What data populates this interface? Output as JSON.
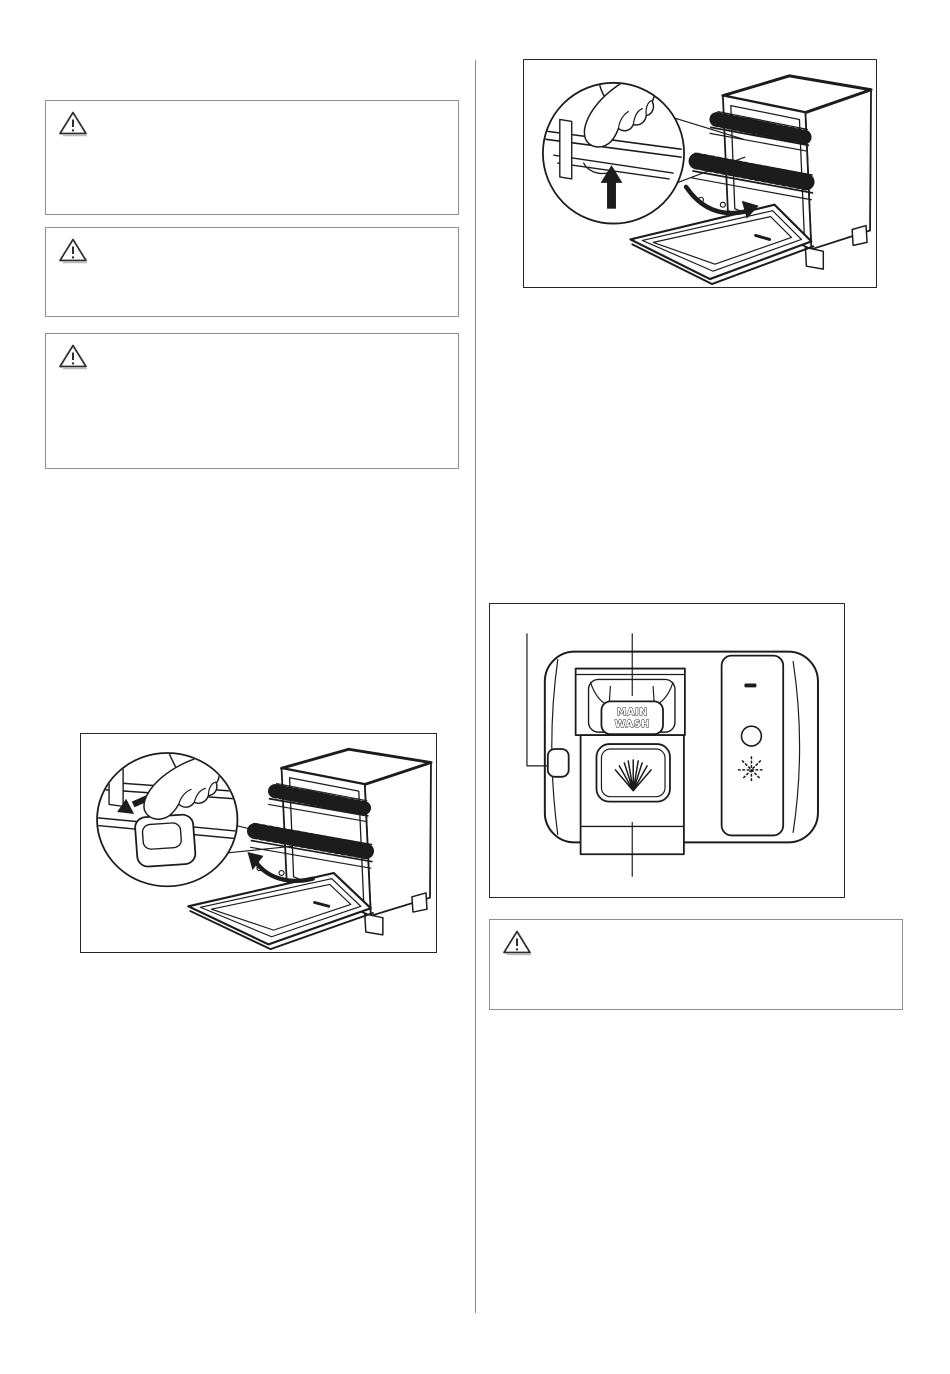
{
  "colors": {
    "page_background": "#ffffff",
    "art_line": "#1c1c1c",
    "warning_box_border": "#8f8f8f",
    "column_divider": "#8a8a8a",
    "arrow_fill": "#1c1c1c"
  },
  "warning_boxes": [
    {
      "name": "warning-box-1",
      "icon": "warning-triangle-icon",
      "text": ""
    },
    {
      "name": "warning-box-2",
      "icon": "warning-triangle-icon",
      "text": ""
    },
    {
      "name": "warning-box-3",
      "icon": "warning-triangle-icon",
      "text": ""
    },
    {
      "name": "warning-box-4",
      "icon": "warning-triangle-icon",
      "text": ""
    }
  ],
  "figures": {
    "basket_release_left": {
      "name": "figure-dishwasher-basket-latch-arrow-left"
    },
    "basket_release_up": {
      "name": "figure-dishwasher-basket-rail-arrow-up"
    },
    "dispenser": {
      "name": "figure-detergent-dispenser",
      "labels": {
        "main_wash_line1": "MAIN",
        "main_wash_line2": "WASH"
      }
    }
  }
}
